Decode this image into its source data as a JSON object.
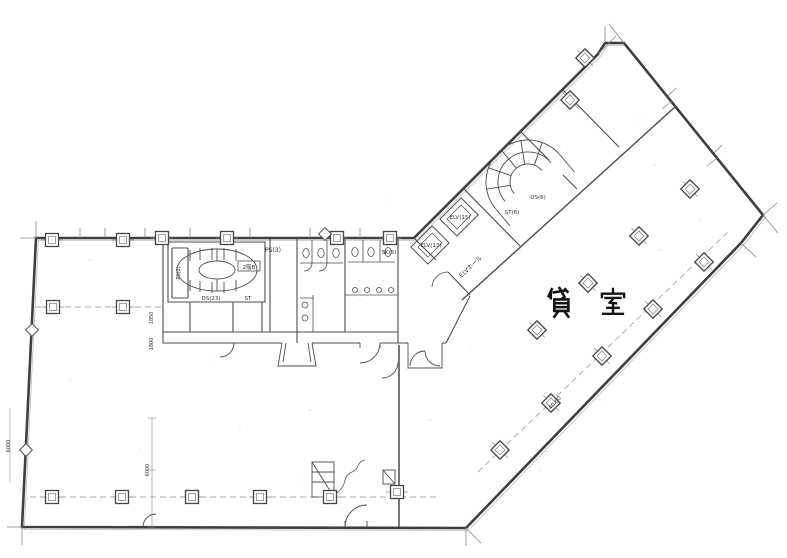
{
  "main_label": {
    "text": "貸 室",
    "char1": "貸",
    "char2": "室",
    "color": "#141414"
  },
  "labels": {
    "ps2": "PS(2)",
    "ds23": "DS(23)",
    "st": "ST",
    "stair_b": "2階B",
    "ps3": "PS(3)",
    "sk5": "SK(5)",
    "elv1": "ELV(13)",
    "elv2": "ELV(15)",
    "elv_hall": "ELVホール",
    "ds6": "DS(6)",
    "st6": "ST(6)"
  },
  "dimensions": {
    "d1": "1850",
    "d2": "1800",
    "d3": "6000",
    "d4": "40.60"
  },
  "style": {
    "wall_color": "#3f3f3f",
    "thin_color": "#555555",
    "ghost_color": "#9a9a9a"
  }
}
